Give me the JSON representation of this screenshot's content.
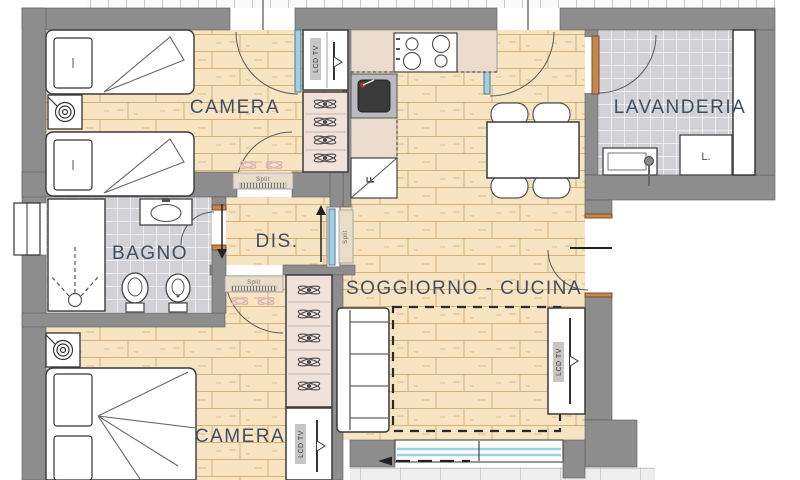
{
  "rooms": {
    "camera_top": {
      "label": "CAMERA"
    },
    "camera_bottom": {
      "label": "CAMERA"
    },
    "bagno": {
      "label": "BAGNO"
    },
    "dis": {
      "label": "DIS."
    },
    "soggiorno": {
      "label": "SOGGIORNO - CUCINA"
    },
    "lavanderia": {
      "label": "LAVANDERIA"
    }
  },
  "fixtures": {
    "tv_label": "LCD TV",
    "split_label": "Split",
    "fridge_label": "F",
    "washer_label": "L."
  },
  "colors": {
    "wall": "#8d8d8d",
    "wood_floor": "#f6e4c2",
    "wood_joint": "#d8b176",
    "bath_tile": "#d1d1d6",
    "balcony_tile": "#eeeeee",
    "kitchen_counter": "#ecdccd",
    "closet_interior": "#f0e1d9",
    "glass_door": "#9fd0e6",
    "wood_door": "#c9854e",
    "label_text": "#3e4e63",
    "split_unit": "#e9ddc9"
  }
}
